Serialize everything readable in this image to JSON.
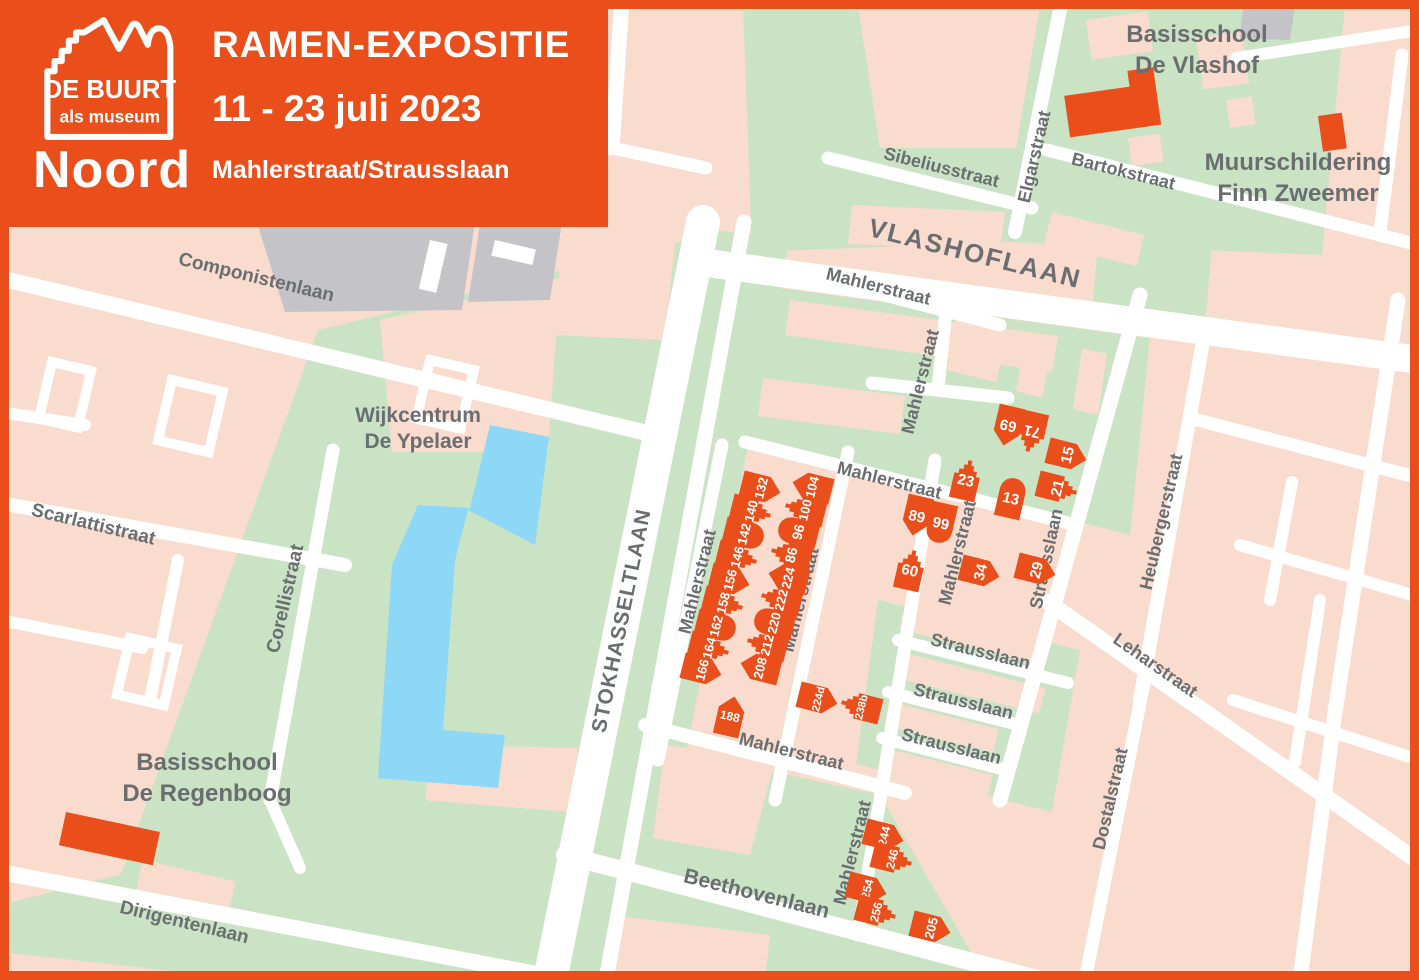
{
  "header": {
    "logo_line1": "DE BUURT",
    "logo_line2": "als museum",
    "region": "Noord",
    "title": "RAMEN-EXPOSITIE",
    "dates": "11 - 23 juli 2023",
    "location": "Mahlerstraat/Strausslaan"
  },
  "colors": {
    "orange": "#e94e1b",
    "pink": "#fadccf",
    "green": "#cae3c5",
    "water": "#8dd7f7",
    "gray_building": "#c4c4c8",
    "label_gray": "#6a6e71",
    "street_white": "#ffffff"
  },
  "map": {
    "street_labels": [
      {
        "text": "Componistenlaan",
        "x": 255,
        "y": 283,
        "rot": 13.5,
        "size": 19
      },
      {
        "text": "Scarlattistraat",
        "x": 92,
        "y": 530,
        "rot": 13.5,
        "size": 19
      },
      {
        "text": "Corellistraat",
        "x": 291,
        "y": 600,
        "rot": -77,
        "size": 19
      },
      {
        "text": "Dirigentenlaan",
        "x": 183,
        "y": 928,
        "rot": 13.5,
        "size": 19
      },
      {
        "text": "STOKHASSELTLAAN",
        "x": 628,
        "y": 622,
        "rot": -78.5,
        "size": 21,
        "ls": 1
      },
      {
        "text": "Beethovenlaan",
        "x": 755,
        "y": 900,
        "rot": 14,
        "size": 21
      },
      {
        "text": "Mahlerstraat",
        "x": 790,
        "y": 757,
        "rot": 14,
        "size": 18
      },
      {
        "text": "Mahlerstraat",
        "x": 703,
        "y": 583,
        "rot": -76,
        "size": 18
      },
      {
        "text": "Mahlerstraat",
        "x": 806,
        "y": 601,
        "rot": -76,
        "size": 18
      },
      {
        "text": "Mahlerstraat",
        "x": 877,
        "y": 292,
        "rot": 14,
        "size": 18
      },
      {
        "text": "Mahlerstraat",
        "x": 926,
        "y": 383,
        "rot": -76,
        "size": 18
      },
      {
        "text": "Mahlerstraat",
        "x": 888,
        "y": 486,
        "rot": 14,
        "size": 18
      },
      {
        "text": "Mahlerstraat",
        "x": 963,
        "y": 554,
        "rot": -76,
        "size": 18
      },
      {
        "text": "Mahlerstraat",
        "x": 858,
        "y": 854,
        "rot": -76,
        "size": 18
      },
      {
        "text": "VLASHOFLAAN",
        "x": 973,
        "y": 262,
        "rot": 14,
        "size": 26,
        "ls": 2
      },
      {
        "text": "Sibeliusstraat",
        "x": 940,
        "y": 173,
        "rot": 14,
        "size": 18
      },
      {
        "text": "Elgarstraat",
        "x": 1040,
        "y": 158,
        "rot": -77,
        "size": 18
      },
      {
        "text": "Bartokstraat",
        "x": 1122,
        "y": 177,
        "rot": 14,
        "size": 18
      },
      {
        "text": "Heubergerstraat",
        "x": 1167,
        "y": 523,
        "rot": -77,
        "size": 18
      },
      {
        "text": "Strausslaan",
        "x": 1052,
        "y": 560,
        "rot": -78,
        "size": 18
      },
      {
        "text": "Strausslaan",
        "x": 979,
        "y": 657,
        "rot": 14,
        "size": 18
      },
      {
        "text": "Strausslaan",
        "x": 962,
        "y": 707,
        "rot": 14,
        "size": 18
      },
      {
        "text": "Strausslaan",
        "x": 950,
        "y": 752,
        "rot": 14,
        "size": 18
      },
      {
        "text": "Leharstraat",
        "x": 1152,
        "y": 670,
        "rot": 35,
        "size": 18
      },
      {
        "text": "Dostalstraat",
        "x": 1116,
        "y": 800,
        "rot": -77,
        "size": 18
      }
    ],
    "landmark_labels": [
      {
        "lines": [
          "Wijkcentrum",
          "De Ypelaer"
        ],
        "x": 418,
        "y": 422,
        "size": 21,
        "lh": 26
      },
      {
        "lines": [
          "Basisschool",
          "De Regenboog"
        ],
        "x": 207,
        "y": 770,
        "size": 24,
        "lh": 31
      },
      {
        "lines": [
          "Basisschool",
          "De Vlashof"
        ],
        "x": 1197,
        "y": 42,
        "size": 24,
        "lh": 31
      },
      {
        "lines": [
          "Muurschildering",
          "Finn Zweemer"
        ],
        "x": 1298,
        "y": 170,
        "size": 24,
        "lh": 31
      }
    ],
    "houses": [
      {
        "num": "132",
        "x": 761,
        "y": 488,
        "rot": 104,
        "trot": -76,
        "shape": "plain",
        "ts": 13
      },
      {
        "num": "140",
        "x": 751,
        "y": 511,
        "rot": 104,
        "trot": -76,
        "shape": "step",
        "ts": 13
      },
      {
        "num": "142",
        "x": 744,
        "y": 534,
        "rot": 104,
        "trot": -76,
        "shape": "round",
        "ts": 13
      },
      {
        "num": "146",
        "x": 737,
        "y": 557,
        "rot": 104,
        "trot": -76,
        "shape": "step",
        "ts": 13
      },
      {
        "num": "156",
        "x": 730,
        "y": 580,
        "rot": 104,
        "trot": -76,
        "shape": "plain",
        "ts": 13
      },
      {
        "num": "158",
        "x": 723,
        "y": 603,
        "rot": 104,
        "trot": -76,
        "shape": "step",
        "ts": 13
      },
      {
        "num": "162",
        "x": 716,
        "y": 626,
        "rot": 104,
        "trot": -76,
        "shape": "round",
        "ts": 13
      },
      {
        "num": "164",
        "x": 709,
        "y": 648,
        "rot": 104,
        "trot": -76,
        "shape": "step",
        "ts": 13
      },
      {
        "num": "166",
        "x": 702,
        "y": 670,
        "rot": 104,
        "trot": -76,
        "shape": "plain",
        "ts": 13
      },
      {
        "num": "188",
        "x": 730,
        "y": 716,
        "rot": 13,
        "trot": 13,
        "shape": "plain",
        "ts": 12
      },
      {
        "num": "104",
        "x": 812,
        "y": 487,
        "rot": -76,
        "trot": -76,
        "shape": "plain",
        "ts": 13
      },
      {
        "num": "100",
        "x": 805,
        "y": 510,
        "rot": -76,
        "trot": -76,
        "shape": "step",
        "ts": 13
      },
      {
        "num": "96",
        "x": 798,
        "y": 532,
        "rot": -76,
        "trot": -76,
        "shape": "round",
        "ts": 14
      },
      {
        "num": "86",
        "x": 791,
        "y": 555,
        "rot": -76,
        "trot": -76,
        "shape": "step",
        "ts": 14
      },
      {
        "num": "224",
        "x": 788,
        "y": 578,
        "rot": -76,
        "trot": -76,
        "shape": "plain",
        "ts": 13
      },
      {
        "num": "222",
        "x": 781,
        "y": 600,
        "rot": -76,
        "trot": -76,
        "shape": "step",
        "ts": 13
      },
      {
        "num": "220",
        "x": 774,
        "y": 623,
        "rot": -76,
        "trot": -76,
        "shape": "round",
        "ts": 13
      },
      {
        "num": "212",
        "x": 767,
        "y": 645,
        "rot": -76,
        "trot": -76,
        "shape": "step",
        "ts": 13
      },
      {
        "num": "208",
        "x": 760,
        "y": 668,
        "rot": -76,
        "trot": -76,
        "shape": "plain",
        "ts": 13
      },
      {
        "num": "224d",
        "x": 818,
        "y": 699,
        "rot": 104,
        "trot": -76,
        "shape": "plain",
        "ts": 11
      },
      {
        "num": "238b",
        "x": 861,
        "y": 707,
        "rot": -76,
        "trot": -76,
        "shape": "step",
        "ts": 11
      },
      {
        "num": "23",
        "x": 966,
        "y": 480,
        "rot": 13,
        "trot": 13,
        "shape": "step",
        "ts": 15
      },
      {
        "num": "13",
        "x": 1011,
        "y": 498,
        "rot": 13,
        "trot": 13,
        "shape": "round",
        "ts": 15
      },
      {
        "num": "69",
        "x": 1008,
        "y": 426,
        "rot": 193,
        "trot": 193,
        "shape": "plain",
        "ts": 15
      },
      {
        "num": "71",
        "x": 1032,
        "y": 432,
        "rot": 193,
        "trot": 193,
        "shape": "step",
        "ts": 15
      },
      {
        "num": "15",
        "x": 1067,
        "y": 455,
        "rot": 104,
        "trot": -76,
        "shape": "plain",
        "ts": 15
      },
      {
        "num": "21",
        "x": 1057,
        "y": 488,
        "rot": 104,
        "trot": -76,
        "shape": "step",
        "ts": 15
      },
      {
        "num": "89",
        "x": 917,
        "y": 516,
        "rot": 193,
        "trot": 13,
        "shape": "plain",
        "ts": 15
      },
      {
        "num": "99",
        "x": 941,
        "y": 523,
        "rot": 193,
        "trot": 13,
        "shape": "round",
        "ts": 15
      },
      {
        "num": "60",
        "x": 910,
        "y": 570,
        "rot": 13,
        "trot": 13,
        "shape": "step",
        "ts": 15
      },
      {
        "num": "34",
        "x": 980,
        "y": 572,
        "rot": 104,
        "trot": -76,
        "shape": "plain",
        "ts": 15
      },
      {
        "num": "29",
        "x": 1036,
        "y": 570,
        "rot": 104,
        "trot": -76,
        "shape": "plain",
        "ts": 15
      },
      {
        "num": "244",
        "x": 884,
        "y": 836,
        "rot": 104,
        "trot": -76,
        "shape": "plain",
        "ts": 12
      },
      {
        "num": "246",
        "x": 892,
        "y": 859,
        "rot": 104,
        "trot": -76,
        "shape": "step",
        "ts": 12
      },
      {
        "num": "254",
        "x": 867,
        "y": 889,
        "rot": 104,
        "trot": -76,
        "shape": "plain",
        "ts": 12
      },
      {
        "num": "256",
        "x": 876,
        "y": 912,
        "rot": 104,
        "trot": -76,
        "shape": "step",
        "ts": 12
      },
      {
        "num": "205",
        "x": 931,
        "y": 928,
        "rot": 104,
        "trot": -76,
        "shape": "plain",
        "ts": 13
      }
    ]
  }
}
